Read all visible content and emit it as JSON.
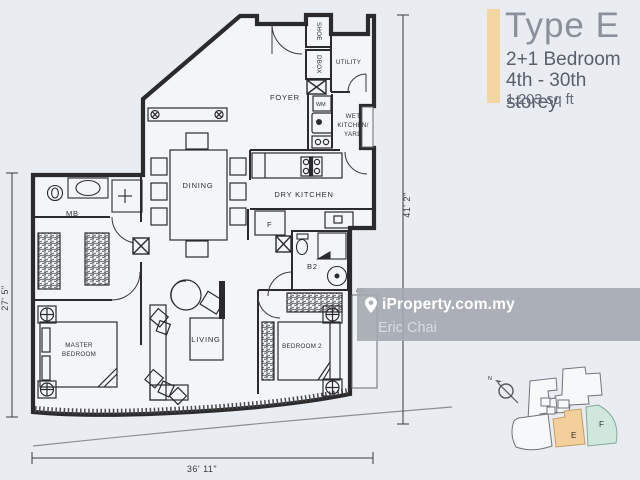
{
  "panel": {
    "title": "Type E",
    "line1": "2+1 Bedroom",
    "line2": "4th - 30th storey",
    "line3": "1,203 sq ft",
    "accent_color": "#f6d6a0"
  },
  "watermark": {
    "brand": "iProperty.com.my",
    "author": "Eric Chai"
  },
  "floor_plan": {
    "labels": {
      "foyer": "FOYER",
      "shoe": "SHOE",
      "dbox": "DBOX",
      "utility": "UTILITY",
      "wm": "WM",
      "wet1": "WET",
      "wet2": "KITCHEN/",
      "wet3": "YARD",
      "dining": "DINING",
      "dry_kitchen": "DRY KITCHEN",
      "fridge": "F",
      "b2": "B2",
      "mb": "MB",
      "living": "LIVING",
      "master1": "MASTER",
      "master2": "BEDROOM",
      "bedroom2": "BEDROOM 2",
      "ac": "A/C"
    },
    "dimensions": {
      "bottom": "36' 11\"",
      "right": "41' 2\"",
      "left": "27' 5\""
    }
  },
  "key_plan": {
    "north": "N",
    "unit_e": "E",
    "unit_f": "F",
    "unit_e_color": "#f2cf9b",
    "unit_f_color": "#cfe7dc"
  }
}
